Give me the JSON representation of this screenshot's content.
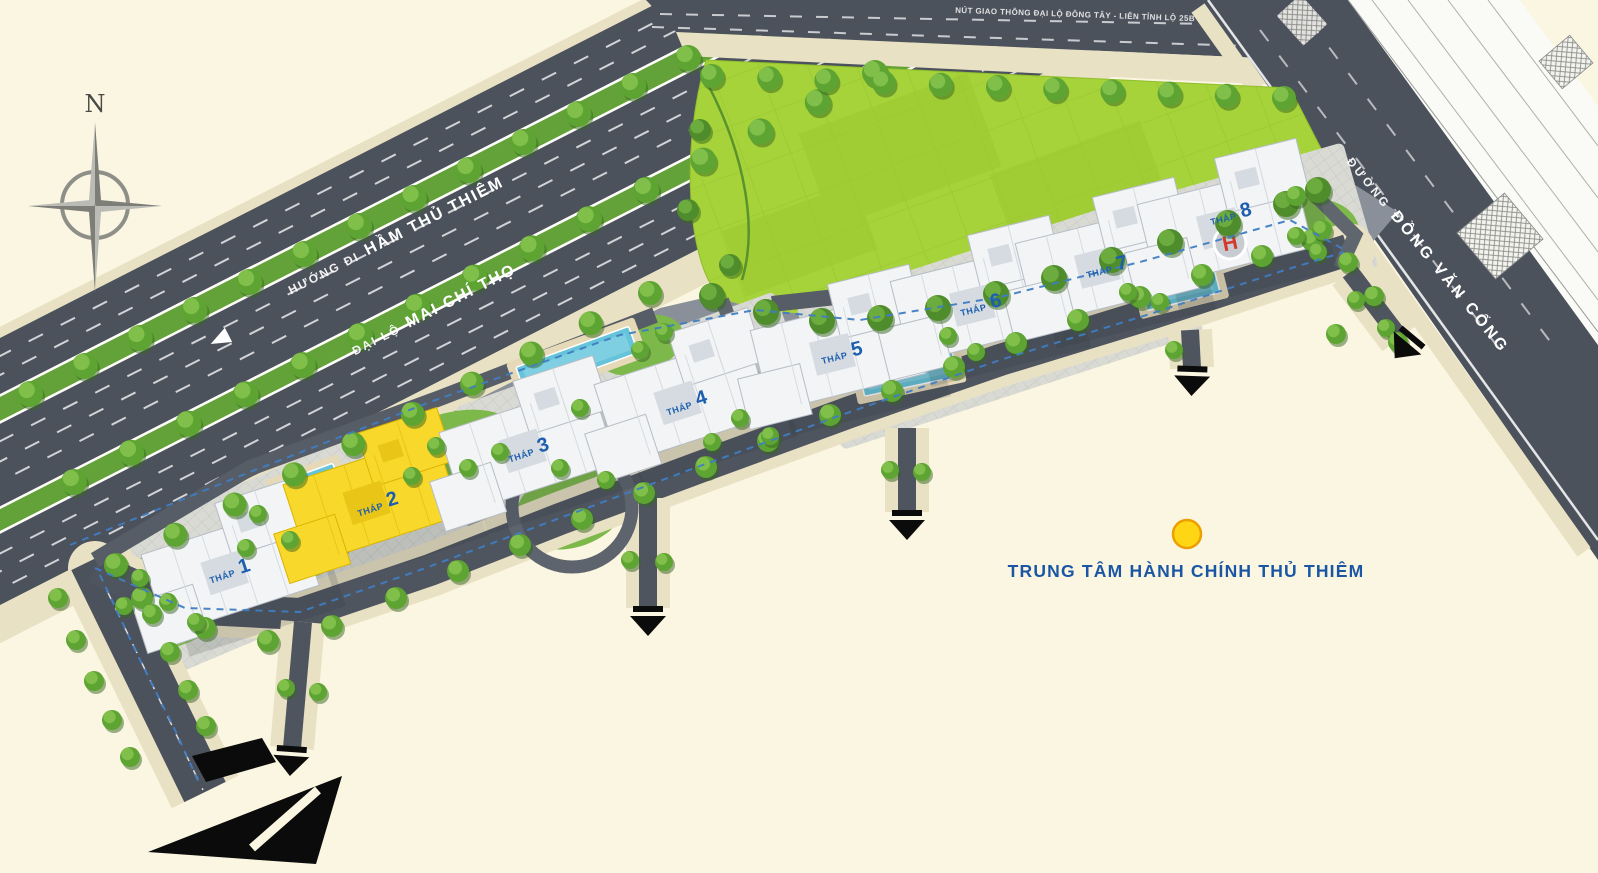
{
  "map": {
    "background_color": "#FBF6E1",
    "compass": {
      "north_label": "N"
    },
    "roads": {
      "top_interchange_label": "NÚT GIAO THÔNG ĐẠI LỘ ĐÔNG TÂY - LIÊN TỈNH LỘ 25B",
      "highway_direction_prefix": "HƯỚNG ĐI",
      "highway_direction_name": "HẦM THỦ THIÊM",
      "boulevard_prefix": "ĐẠI LỘ",
      "boulevard_name": "MAI CHÍ THỌ",
      "street_prefix": "ĐƯỜNG",
      "street_name": "ĐỒNG VĂN CỐNG"
    },
    "towers": [
      {
        "prefix": "THÁP",
        "number": "1"
      },
      {
        "prefix": "THÁP",
        "number": "2"
      },
      {
        "prefix": "THÁP",
        "number": "3"
      },
      {
        "prefix": "THÁP",
        "number": "4"
      },
      {
        "prefix": "THÁP",
        "number": "5"
      },
      {
        "prefix": "THÁP",
        "number": "6"
      },
      {
        "prefix": "THÁP",
        "number": "7"
      },
      {
        "prefix": "THÁP",
        "number": "8"
      }
    ],
    "helipad_label": "H",
    "poi": {
      "label": "TRUNG TÂM HÀNH CHÍNH THỦ THIÊM",
      "marker_color": "#FFD614"
    },
    "colors": {
      "label_blue": "#1D5FAE",
      "title_blue": "#1B56A4",
      "road_dark": "#4C525C",
      "median_green": "#63A238",
      "park_green": "#A6D33A",
      "sidewalk_beige": "#E9E1C4",
      "tower2_yellow": "#F8D92B",
      "pool_blue": "#66C4DA",
      "bike_path_blue": "#3F7DC2"
    }
  }
}
